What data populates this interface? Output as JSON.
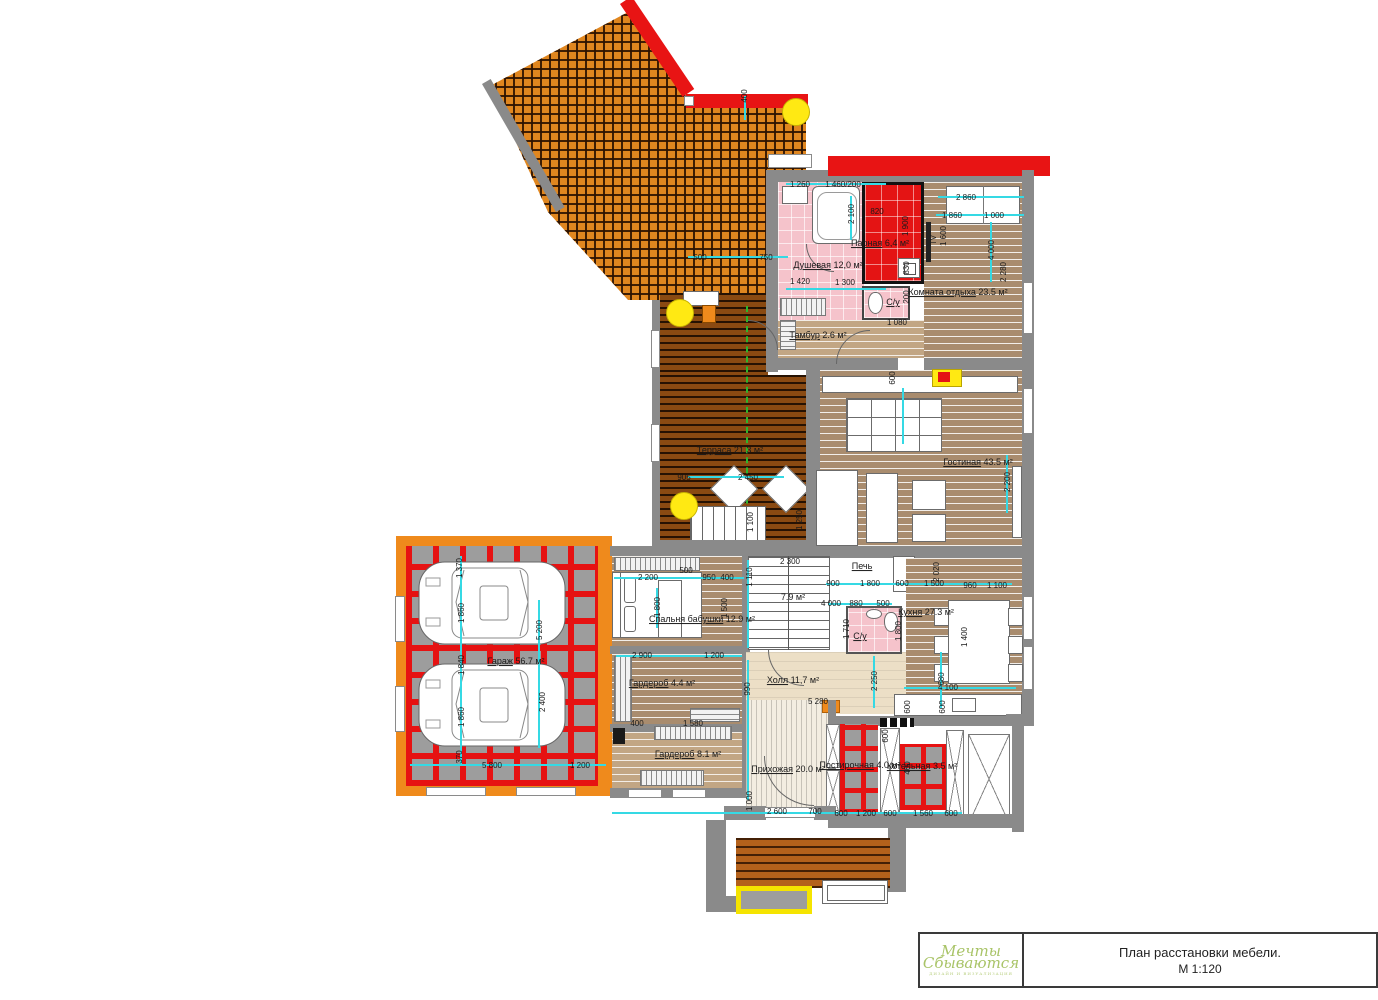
{
  "title_block": {
    "project_title": "План расстановки мебели.",
    "scale": "М 1:120",
    "logo_line1": "Мечты",
    "logo_line2": "Сбываются",
    "logo_sub": "ДИЗАЙН И ВИЗУАЛИЗАЦИЯ"
  },
  "rooms": [
    {
      "name": "Душевая",
      "area": "12,0 м²",
      "x": 828,
      "y": 266
    },
    {
      "name": "Парная",
      "area": "6,4 м²",
      "x": 880,
      "y": 244
    },
    {
      "name": "С/у",
      "area": "",
      "x": 893,
      "y": 303
    },
    {
      "name": "Тамбур",
      "area": "2.6 м²",
      "x": 818,
      "y": 336
    },
    {
      "name": "Комната отдыха",
      "area": "23.5 м²",
      "x": 958,
      "y": 293
    },
    {
      "name": "Гостиная",
      "area": "43.5 м²",
      "x": 978,
      "y": 463
    },
    {
      "name": "Терраса",
      "area": "21.3 м²",
      "x": 730,
      "y": 451
    },
    {
      "name": "Гараж",
      "area": "56.7 м²",
      "x": 516,
      "y": 662
    },
    {
      "name": "Спальня бабушки",
      "area": "12.9 м²",
      "x": 702,
      "y": 620
    },
    {
      "name": "",
      "area": "7.9 м²",
      "x": 793,
      "y": 598
    },
    {
      "name": "Холл",
      "area": "11,7 м²",
      "x": 793,
      "y": 681
    },
    {
      "name": "С/у",
      "area": "",
      "x": 860,
      "y": 637
    },
    {
      "name": "Печь",
      "area": "",
      "x": 862,
      "y": 567
    },
    {
      "name": "Кухня",
      "area": "27.3 м²",
      "x": 926,
      "y": 613
    },
    {
      "name": "Гардероб",
      "area": "4.4 м²",
      "x": 662,
      "y": 684
    },
    {
      "name": "Гардероб",
      "area": "8.1 м²",
      "x": 688,
      "y": 755
    },
    {
      "name": "Прихожая",
      "area": "20.0 м²",
      "x": 788,
      "y": 770
    },
    {
      "name": "Постирочная",
      "area": "4.0 м²",
      "x": 860,
      "y": 766
    },
    {
      "name": "Котельная",
      "area": "3.5 м²",
      "x": 922,
      "y": 767
    }
  ],
  "dims": [
    {
      "t": "400",
      "x": 745,
      "y": 96,
      "r": -90
    },
    {
      "t": "500",
      "x": 700,
      "y": 258
    },
    {
      "t": "750",
      "x": 766,
      "y": 258
    },
    {
      "t": "1 260",
      "x": 800,
      "y": 185
    },
    {
      "t": "1 460/200",
      "x": 843,
      "y": 185
    },
    {
      "t": "820",
      "x": 877,
      "y": 212
    },
    {
      "t": "2 100",
      "x": 852,
      "y": 214,
      "r": -90
    },
    {
      "t": "1 900",
      "x": 906,
      "y": 226,
      "r": -90
    },
    {
      "t": "830",
      "x": 907,
      "y": 268,
      "r": -90
    },
    {
      "t": "200",
      "x": 907,
      "y": 297,
      "r": -90
    },
    {
      "t": "2 860",
      "x": 966,
      "y": 198
    },
    {
      "t": "1 860",
      "x": 952,
      "y": 216
    },
    {
      "t": "1 000",
      "x": 994,
      "y": 216
    },
    {
      "t": "1 600",
      "x": 944,
      "y": 236,
      "r": -90
    },
    {
      "t": "4 000",
      "x": 992,
      "y": 250,
      "r": -90
    },
    {
      "t": "2 280",
      "x": 1004,
      "y": 272,
      "r": -90
    },
    {
      "t": "TV",
      "x": 934,
      "y": 240,
      "r": -90
    },
    {
      "t": "1 420",
      "x": 800,
      "y": 282
    },
    {
      "t": "1 300",
      "x": 845,
      "y": 283
    },
    {
      "t": "1 080",
      "x": 897,
      "y": 323
    },
    {
      "t": "1 250",
      "x": 800,
      "y": 520,
      "r": -90
    },
    {
      "t": "2 200",
      "x": 1008,
      "y": 482,
      "r": -90
    },
    {
      "t": "600",
      "x": 893,
      "y": 378,
      "r": -90
    },
    {
      "t": "905",
      "x": 684,
      "y": 478
    },
    {
      "t": "2 450",
      "x": 748,
      "y": 478
    },
    {
      "t": "1 100",
      "x": 751,
      "y": 522,
      "r": -90
    },
    {
      "t": "1 370",
      "x": 460,
      "y": 568,
      "r": -90
    },
    {
      "t": "1 860",
      "x": 462,
      "y": 613,
      "r": -90
    },
    {
      "t": "1 840",
      "x": 462,
      "y": 665,
      "r": -90
    },
    {
      "t": "1 860",
      "x": 462,
      "y": 717,
      "r": -90
    },
    {
      "t": "370",
      "x": 460,
      "y": 757,
      "r": -90
    },
    {
      "t": "5 800",
      "x": 492,
      "y": 766
    },
    {
      "t": "1 200",
      "x": 580,
      "y": 766
    },
    {
      "t": "5 200",
      "x": 540,
      "y": 630,
      "r": -90
    },
    {
      "t": "2 400",
      "x": 543,
      "y": 702,
      "r": -90
    },
    {
      "t": "2 300",
      "x": 790,
      "y": 562
    },
    {
      "t": "2 200",
      "x": 648,
      "y": 578
    },
    {
      "t": "500",
      "x": 686,
      "y": 571
    },
    {
      "t": "950",
      "x": 709,
      "y": 578
    },
    {
      "t": "400",
      "x": 727,
      "y": 578
    },
    {
      "t": "1 110",
      "x": 750,
      "y": 577,
      "r": -90
    },
    {
      "t": "1 800",
      "x": 658,
      "y": 607,
      "r": -90
    },
    {
      "t": "1 500",
      "x": 725,
      "y": 608,
      "r": -90
    },
    {
      "t": "2 900",
      "x": 642,
      "y": 656
    },
    {
      "t": "1 200",
      "x": 714,
      "y": 656
    },
    {
      "t": "900",
      "x": 833,
      "y": 584
    },
    {
      "t": "1 800",
      "x": 870,
      "y": 584
    },
    {
      "t": "600",
      "x": 902,
      "y": 584
    },
    {
      "t": "1 500",
      "x": 934,
      "y": 584
    },
    {
      "t": "960",
      "x": 970,
      "y": 586
    },
    {
      "t": "1 100",
      "x": 997,
      "y": 586
    },
    {
      "t": "4 000",
      "x": 831,
      "y": 604
    },
    {
      "t": "880",
      "x": 856,
      "y": 604
    },
    {
      "t": "500",
      "x": 883,
      "y": 604
    },
    {
      "t": "1 710",
      "x": 847,
      "y": 629,
      "r": -90
    },
    {
      "t": "1 800",
      "x": 899,
      "y": 631,
      "r": -90
    },
    {
      "t": "2 020",
      "x": 937,
      "y": 572,
      "r": -90
    },
    {
      "t": "1 400",
      "x": 965,
      "y": 637,
      "r": -90
    },
    {
      "t": "2 250",
      "x": 875,
      "y": 681,
      "r": -90
    },
    {
      "t": "680",
      "x": 942,
      "y": 679,
      "r": -90
    },
    {
      "t": "4 100",
      "x": 948,
      "y": 688
    },
    {
      "t": "600",
      "x": 908,
      "y": 707,
      "r": -90
    },
    {
      "t": "600",
      "x": 943,
      "y": 707,
      "r": -90
    },
    {
      "t": "5 280",
      "x": 818,
      "y": 702
    },
    {
      "t": "400",
      "x": 637,
      "y": 724
    },
    {
      "t": "1 580",
      "x": 693,
      "y": 724
    },
    {
      "t": "990",
      "x": 748,
      "y": 689,
      "r": -90
    },
    {
      "t": "1 000",
      "x": 750,
      "y": 801,
      "r": -90
    },
    {
      "t": "2 600",
      "x": 777,
      "y": 812
    },
    {
      "t": "700",
      "x": 815,
      "y": 812
    },
    {
      "t": "600",
      "x": 841,
      "y": 814
    },
    {
      "t": "1 200",
      "x": 866,
      "y": 814
    },
    {
      "t": "600",
      "x": 890,
      "y": 814
    },
    {
      "t": "1 560",
      "x": 923,
      "y": 814
    },
    {
      "t": "600",
      "x": 951,
      "y": 814
    },
    {
      "t": "400",
      "x": 908,
      "y": 768,
      "r": -90
    },
    {
      "t": "600",
      "x": 886,
      "y": 736,
      "r": -90
    }
  ],
  "colors": {
    "wall_gray": "#8a8a8a",
    "wall_orange": "#ef8a1c",
    "wall_red": "#e81414",
    "dim_cyan": "#35d9e4",
    "section_green": "#2db52d",
    "lamp_yellow": "#ffe913",
    "floor_pink": "#f5c3cb",
    "sauna_red": "#e41414",
    "logo_green": "#a9c468"
  }
}
